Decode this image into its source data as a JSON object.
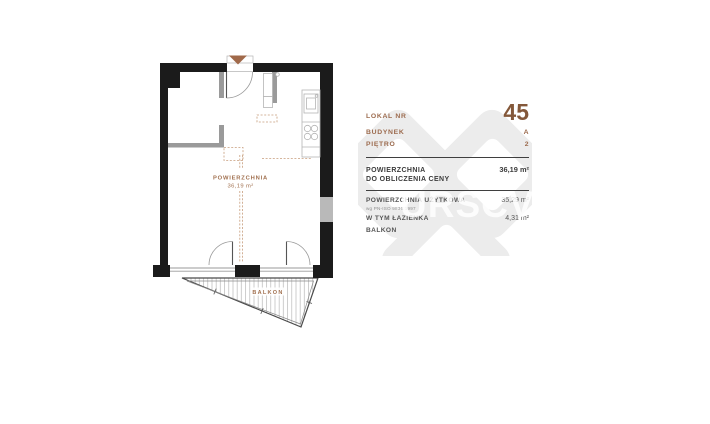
{
  "plan": {
    "area_label": "POWIERZCHNIA",
    "area_value": "36,19 m²",
    "balcony_label": "BALKON"
  },
  "card": {
    "lokal_label": "LOKAL NR",
    "lokal_value": "45",
    "budynek_label": "BUDYNEK",
    "budynek_value": "A",
    "pietro_label": "PIĘTRO",
    "pietro_value": "2",
    "price_area_label_line1": "POWIERZCHNIA",
    "price_area_label_line2": "DO OBLICZENIA CENY",
    "price_area_value": "36,19 m²",
    "usable_area_label": "POWIERZCHNIA UŻYTKOWA",
    "usable_area_sublabel": "wg PN-ISO 9836:1997",
    "usable_area_value": "35,29 m²",
    "bathroom_label": "W TYM ŁAZIENKA",
    "bathroom_value": "4,31 m²",
    "balcony_label": "BALKON"
  },
  "watermark": {
    "text": "URSCV"
  },
  "colors": {
    "accent_copper": "#9c6b4e",
    "wall_black": "#1b1b1b",
    "text_dark": "#3c3c3c",
    "watermark_gray": "#ececec",
    "dashed_tan": "#c79d7c"
  }
}
